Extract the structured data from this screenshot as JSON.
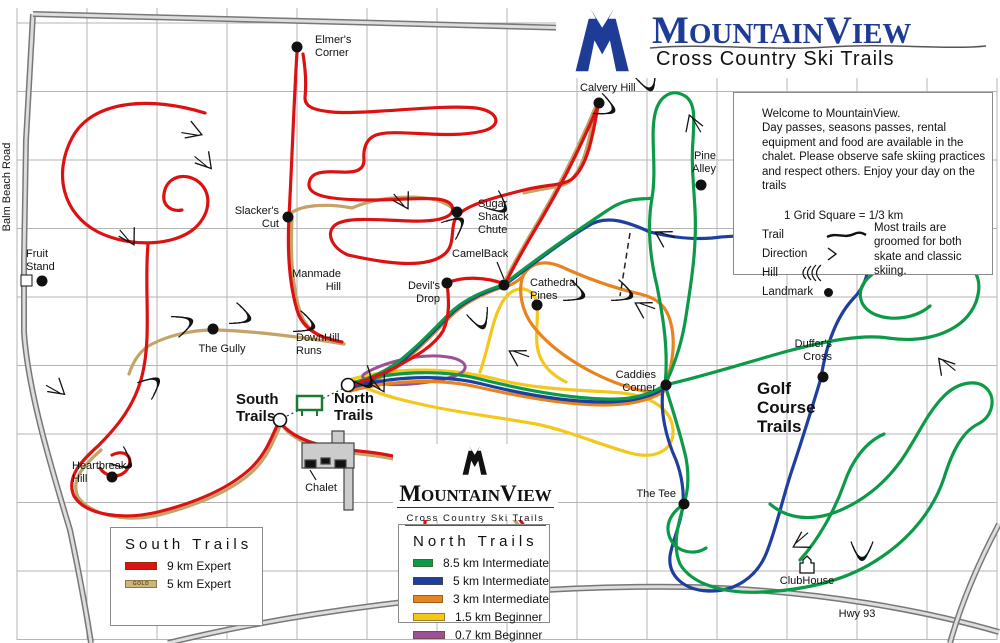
{
  "logo": {
    "m": "M",
    "ountain": "OUNTAIN",
    "v": "V",
    "iew": "IEW",
    "tagline": "Cross Country Ski Trails"
  },
  "info_box": {
    "line1": "Welcome to MountainView.",
    "line2": "Day passes, seasons passes, rental equipment and food are available in the chalet. Please observe safe skiing practices and respect others. Enjoy your day on the trails",
    "scale_note": "1 Grid Square = 1/3 km",
    "key_trail": "Trail",
    "key_direction": "Direction",
    "key_hill": "Hill",
    "key_landmark": "Landmark",
    "groomed_note": "Most trails are groomed for both skate and classic skiing."
  },
  "south_legend": {
    "title": "South Trails",
    "items": [
      {
        "color": "#dc1212",
        "swatch_text": "",
        "label": "9 km Expert"
      },
      {
        "color": "#cdb47e",
        "swatch_text": "GOLD",
        "label": "5  km Expert"
      }
    ]
  },
  "north_legend": {
    "title": "North Trails",
    "items": [
      {
        "color": "#0d9a48",
        "swatch_text": "",
        "label": "8.5 km Intermediate"
      },
      {
        "color": "#1e3f9e",
        "swatch_text": "",
        "label": "5  km Intermediate"
      },
      {
        "color": "#e88420",
        "swatch_text": "",
        "label": "3  km Intermediate"
      },
      {
        "color": "#f3c71b",
        "swatch_text": "",
        "label": "1.5  km Beginner"
      },
      {
        "color": "#9c5098",
        "swatch_text": "",
        "label": "0.7 km Beginner"
      }
    ]
  },
  "trail_colors": {
    "red_9km": "#dc1212",
    "gold_5km": "#c3a368",
    "green_8_5km": "#0d9a48",
    "blue_5km": "#1e3f9e",
    "orange_3km": "#e88420",
    "yellow_1_5km": "#f3c71b",
    "purple_0_7km": "#9c5098"
  },
  "landmarks": [
    {
      "name": "elmers-corner",
      "label": [
        "Elmer's",
        "Corner"
      ],
      "dot": [
        297,
        47
      ],
      "lx": 315,
      "ly": 43,
      "anchor": "start"
    },
    {
      "name": "calvery-hill",
      "label": [
        "Calvery Hill"
      ],
      "dot": [
        599,
        103
      ],
      "lx": 580,
      "ly": 91,
      "anchor": "start"
    },
    {
      "name": "pine-alley",
      "label": [
        "Pine",
        "Alley"
      ],
      "dot": [
        701,
        185
      ],
      "lx": 716,
      "ly": 159,
      "anchor": "end"
    },
    {
      "name": "slackers-cut",
      "label": [
        "Slacker's",
        "Cut"
      ],
      "dot": [
        288,
        217
      ],
      "lx": 279,
      "ly": 214,
      "anchor": "end"
    },
    {
      "name": "sugar-shack-chute",
      "label": [
        "Sugar",
        "Shack",
        "Chute"
      ],
      "dot": [
        457,
        212
      ],
      "lx": 478,
      "ly": 207,
      "anchor": "start"
    },
    {
      "name": "camelback",
      "label": [
        "CamelBack"
      ],
      "dot": [
        504,
        285
      ],
      "lx": 452,
      "ly": 257,
      "anchor": "start"
    },
    {
      "name": "cathedral-pines",
      "label": [
        "Cathedral",
        "Pines"
      ],
      "dot": [
        537,
        305
      ],
      "lx": 530,
      "ly": 286,
      "anchor": "start"
    },
    {
      "name": "devils-drop",
      "label": [
        "Devil's",
        "Drop"
      ],
      "dot": [
        447,
        283
      ],
      "lx": 440,
      "ly": 289,
      "anchor": "end"
    },
    {
      "name": "manmade-hill",
      "label": [
        "Manmade",
        "Hill"
      ],
      "lx": 341,
      "ly": 277,
      "anchor": "end"
    },
    {
      "name": "fruit-stand",
      "label": [
        "Fruit",
        "Stand"
      ],
      "dot": [
        42,
        281
      ],
      "square": [
        21,
        275
      ],
      "lx": 26,
      "ly": 257,
      "anchor": "start"
    },
    {
      "name": "the-gully",
      "label": [
        "The Gully"
      ],
      "dot": [
        213,
        329
      ],
      "lx": 222,
      "ly": 352,
      "anchor": "middle"
    },
    {
      "name": "downhill-runs",
      "label": [
        "DownHill",
        "Runs"
      ],
      "lx": 296,
      "ly": 341,
      "anchor": "start"
    },
    {
      "name": "heartbreak-hill",
      "label": [
        "Heartbreak",
        "Hill"
      ],
      "dot": [
        112,
        477
      ],
      "lx": 72,
      "ly": 469,
      "anchor": "start"
    },
    {
      "name": "caddies-corner",
      "label": [
        "Caddies",
        "Corner"
      ],
      "dot": [
        666,
        385
      ],
      "lx": 656,
      "ly": 378,
      "anchor": "end"
    },
    {
      "name": "duffers-cross",
      "label": [
        "Duffer's",
        "Cross"
      ],
      "dot": [
        823,
        377
      ],
      "lx": 832,
      "ly": 347,
      "anchor": "end"
    },
    {
      "name": "the-tee",
      "label": [
        "The Tee"
      ],
      "dot": [
        684,
        504
      ],
      "lx": 676,
      "ly": 497,
      "anchor": "end"
    },
    {
      "name": "clubhouse",
      "label": [
        "ClubHouse"
      ],
      "house": [
        807,
        565
      ],
      "lx": 807,
      "ly": 584,
      "anchor": "middle"
    }
  ],
  "area_labels": [
    {
      "name": "south-trails-label",
      "label": [
        "South",
        "Trails"
      ],
      "x": 236,
      "y": 404,
      "anchor": "start",
      "bold": true,
      "size": 15
    },
    {
      "name": "north-trails-label",
      "label": [
        "North",
        "Trails"
      ],
      "x": 334,
      "y": 403,
      "anchor": "start",
      "bold": true,
      "size": 15
    },
    {
      "name": "golf-course-trails-label",
      "label": [
        "Golf",
        "Course",
        "Trails"
      ],
      "x": 757,
      "y": 394,
      "anchor": "start",
      "bold": true,
      "size": 17
    },
    {
      "name": "chalet-label",
      "label": [
        "Chalet"
      ],
      "x": 321,
      "y": 491,
      "anchor": "middle",
      "bold": false,
      "size": 11
    },
    {
      "name": "hwy-93-label",
      "label": [
        "Hwy 93"
      ],
      "x": 857,
      "y": 617,
      "anchor": "middle",
      "bold": false,
      "size": 12
    },
    {
      "name": "balm-beach-road-label",
      "label": [
        "Balm Beach Road"
      ],
      "x": 10,
      "y": 187,
      "anchor": "middle",
      "bold": false,
      "size": 11,
      "rotate": -90
    }
  ]
}
